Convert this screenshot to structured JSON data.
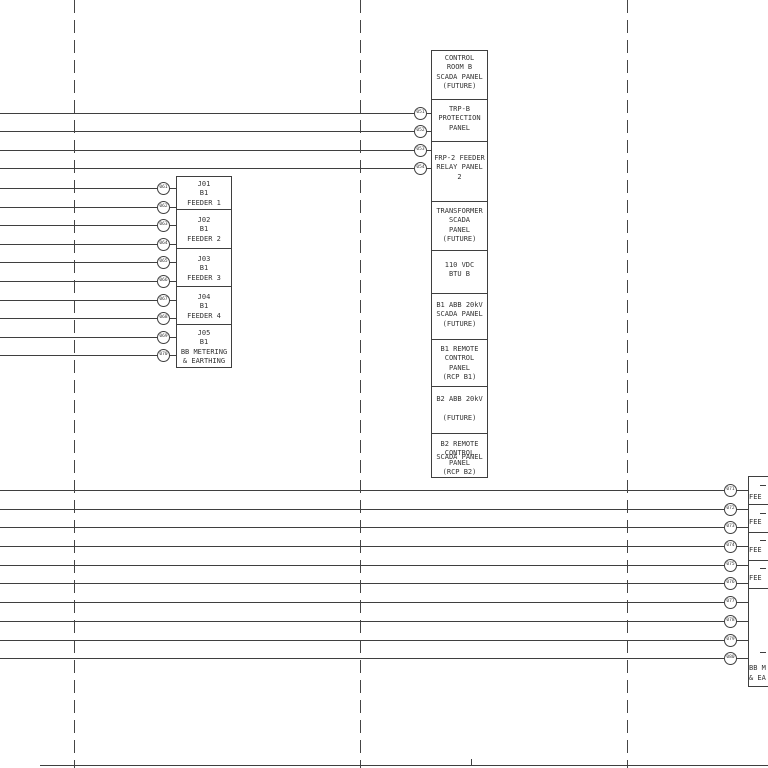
{
  "colors": {
    "line": "#3f3f3f",
    "text": "#333333",
    "background": "#ffffff"
  },
  "cable_tags": {
    "top": [
      "051",
      "052",
      "053",
      "054"
    ],
    "left": [
      "061",
      "062",
      "063",
      "064",
      "065",
      "066",
      "067",
      "068",
      "069",
      "070"
    ],
    "right": [
      "071",
      "072",
      "073",
      "074",
      "075",
      "076",
      "077",
      "078",
      "079",
      "080"
    ]
  },
  "top_stack": {
    "cells": [
      {
        "lines": [
          "CONTROL",
          "ROOM B",
          "SCADA PANEL",
          "(FUTURE)"
        ]
      },
      {
        "lines": [
          "TRP-B",
          "PROTECTION",
          "PANEL"
        ]
      },
      {
        "lines": [
          "FRP-2 FEEDER",
          "RELAY PANEL",
          "2"
        ]
      },
      {
        "lines": [
          "TRANSFORMER",
          "SCADA",
          "PANEL",
          "(FUTURE)"
        ]
      },
      {
        "lines": [
          "110 VDC",
          "BTU B"
        ]
      },
      {
        "lines": [
          "B1 ABB 20kV",
          "SCADA PANEL",
          "(FUTURE)"
        ]
      },
      {
        "lines": [
          "B1 REMOTE",
          "CONTROL",
          "PANEL",
          "(RCP B1)"
        ]
      },
      {
        "lines": [
          "B2 ABB 20kV",
          "",
          "(FUTURE)"
        ]
      },
      {
        "lines": [
          "B2 REMOTE",
          "CONTROL",
          "PANEL",
          "(RCP B2)"
        ],
        "overlap_text": "SCADA PANEL"
      }
    ]
  },
  "left_stack": {
    "cells": [
      {
        "lines": [
          "J01",
          "B1",
          "FEEDER 1"
        ]
      },
      {
        "lines": [
          "J02",
          "B1",
          "FEEDER 2"
        ]
      },
      {
        "lines": [
          "J03",
          "B1",
          "FEEDER 3"
        ]
      },
      {
        "lines": [
          "J04",
          "B1",
          "FEEDER 4"
        ]
      },
      {
        "lines": [
          "J05",
          "B1",
          "BB METERING",
          "& EARTHING"
        ]
      }
    ]
  },
  "right_stack": {
    "cells": [
      {
        "lines": [
          "FEE"
        ]
      },
      {
        "lines": [
          "FEE"
        ]
      },
      {
        "lines": [
          "FEE"
        ]
      },
      {
        "lines": [
          "FEE"
        ]
      },
      {
        "lines": [
          "BB M",
          "& EA"
        ]
      }
    ]
  }
}
